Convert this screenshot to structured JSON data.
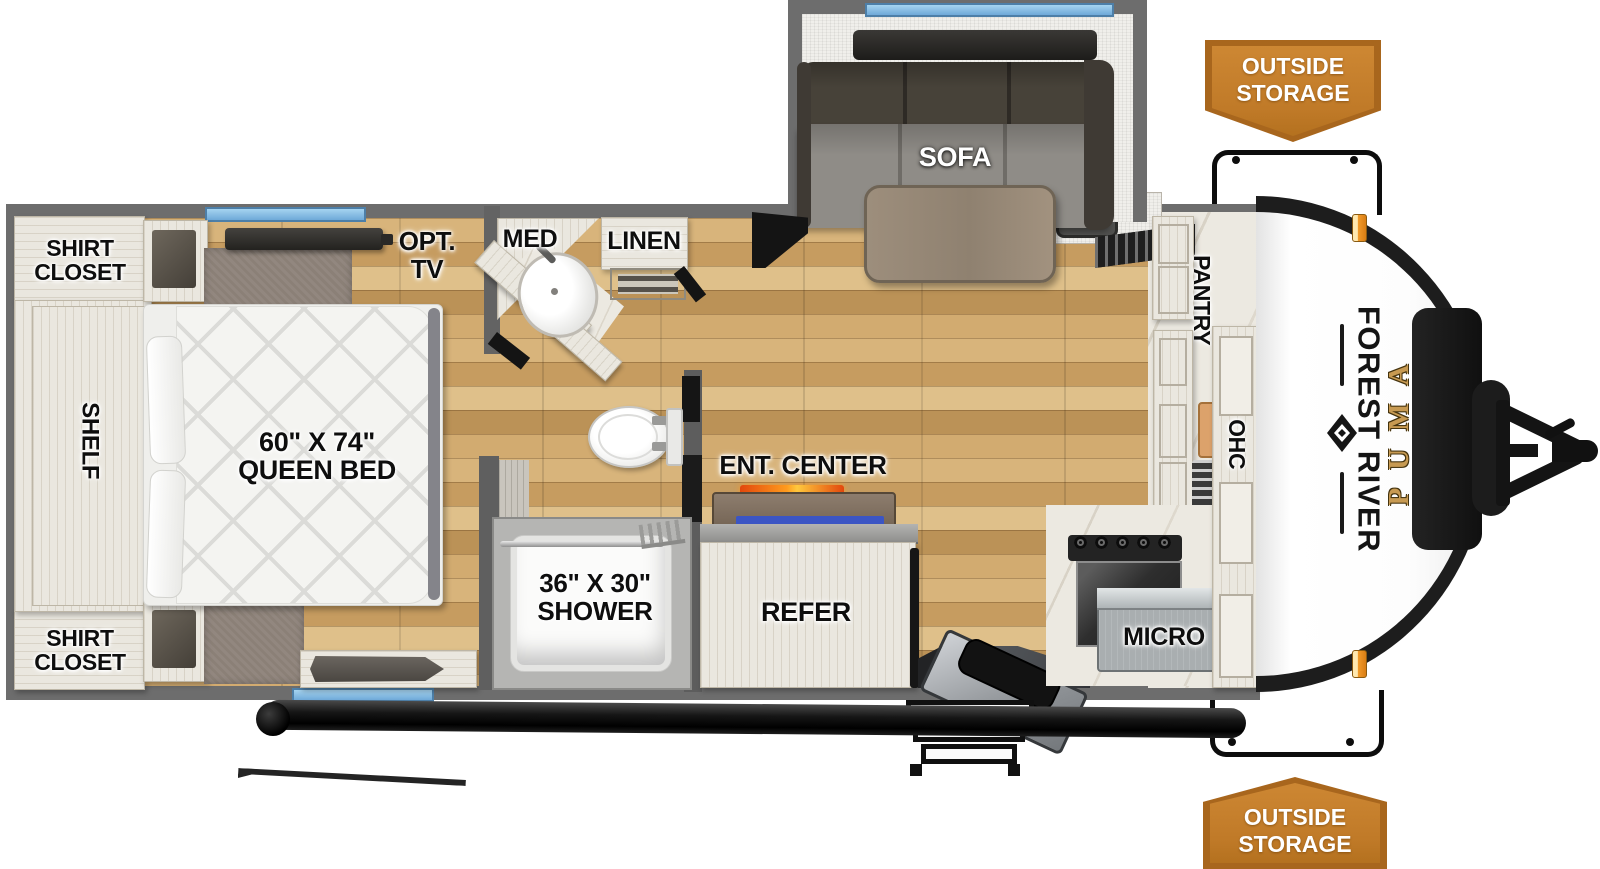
{
  "badges": {
    "outside_storage_top": "OUTSIDE STORAGE",
    "outside_storage_bottom": "OUTSIDE STORAGE"
  },
  "bedroom": {
    "shirt_closet_top": "SHIRT CLOSET",
    "shirt_closet_bottom": "SHIRT CLOSET",
    "shelf": "SHELF",
    "bed_size": "60\" X 74\"",
    "bed_type": "QUEEN BED",
    "opt_tv": "OPT. TV"
  },
  "bathroom": {
    "med": "MED",
    "linen": "LINEN",
    "shower_size": "36\" X 30\"",
    "shower": "SHOWER"
  },
  "living": {
    "sofa": "SOFA",
    "ent_center": "ENT. CENTER",
    "refer": "REFER"
  },
  "kitchen": {
    "pantry": "PANTRY",
    "ohc": "OHC",
    "micro": "MICRO"
  },
  "branding": {
    "manufacturer": "FOREST RIVER",
    "model": "PUMA"
  },
  "colors": {
    "badge_orange": "#c07a28",
    "window_blue": "#7db8e8",
    "wall_gray": "#6d6d6d",
    "floor_wood": "#c9a066",
    "brand_gold": "#c79a52"
  }
}
